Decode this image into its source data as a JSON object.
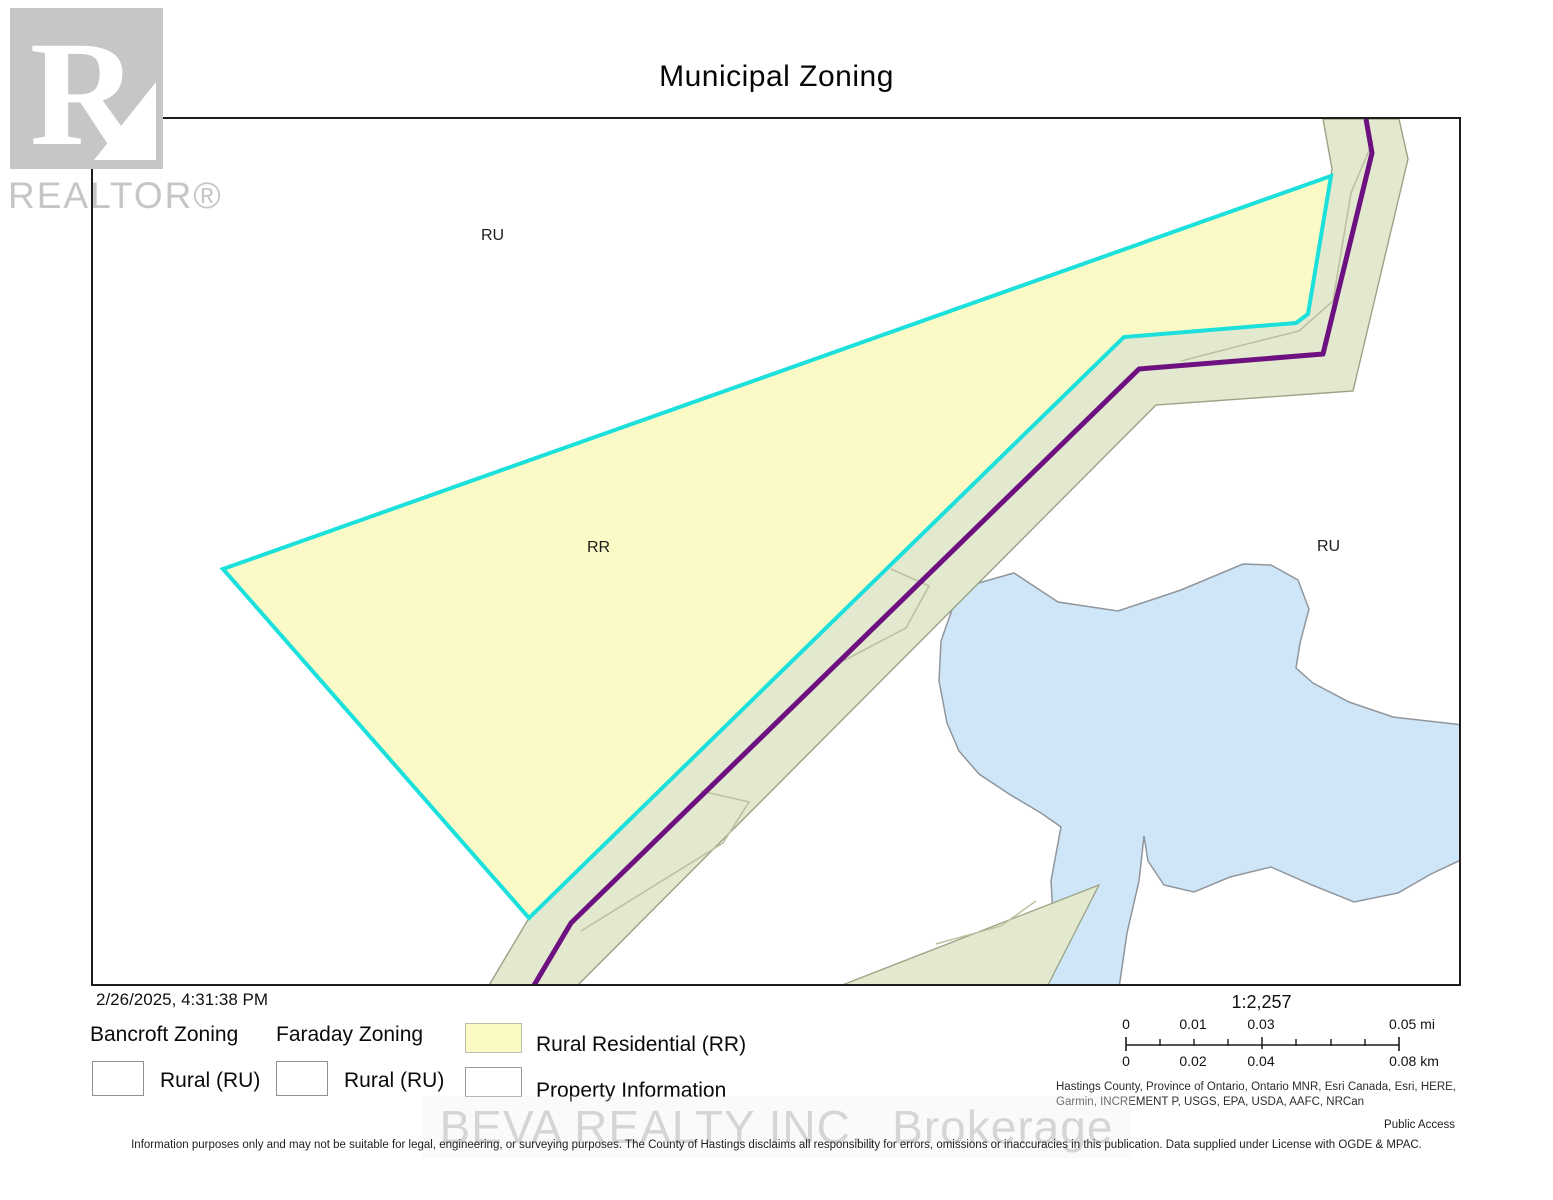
{
  "title": "Municipal Zoning",
  "branding": {
    "realtor_logo_letter": "R",
    "realtor_wordmark": "REALTOR®",
    "brokerage_watermark": "BEVA REALTY INC.,  Brokerage"
  },
  "map": {
    "zone_labels": [
      {
        "text": "RU",
        "area": "upper-left rural zone"
      },
      {
        "text": "RR",
        "area": "highlighted rural-residential parcel"
      },
      {
        "text": "RU",
        "area": "right rural zone near lake"
      }
    ],
    "colors": {
      "property_fill": "#fbfac6",
      "property_outline": "#1ce0db",
      "road_corridor_fill": "#e3e9cf",
      "road_corridor_outline": "#9ba285",
      "municipal_boundary_line": "#6d1180",
      "water_fill": "#cee6f7",
      "water_outline": "#90969c"
    }
  },
  "legend": {
    "timestamp": "2/26/2025, 4:31:38 PM",
    "groups": [
      {
        "heading": "Bancroft Zoning",
        "item": "Rural (RU)"
      },
      {
        "heading": "Faraday Zoning",
        "item": "Rural (RU)"
      }
    ],
    "zone_items": [
      {
        "label": "Rural Residential (RR)"
      },
      {
        "label": "Property Information"
      }
    ]
  },
  "scalebar": {
    "ratio": "1:2,257",
    "mi_labels": [
      "0",
      "0.01",
      "0.03",
      "0.05 mi"
    ],
    "km_labels": [
      "0",
      "0.02",
      "0.04",
      "0.08 km"
    ]
  },
  "credits": {
    "attribution": "Hastings County, Province of Ontario, Ontario MNR, Esri Canada, Esri, HERE, Garmin, INCREMENT P, USGS, EPA, USDA, AAFC, NRCan",
    "access": "Public Access",
    "disclaimer": "Information purposes only and may not be suitable for legal, engineering, or surveying purposes.  The County of Hastings disclaims all responsibility for errors, omissions or inaccuracies in this publication. Data supplied under License with OGDE & MPAC."
  }
}
